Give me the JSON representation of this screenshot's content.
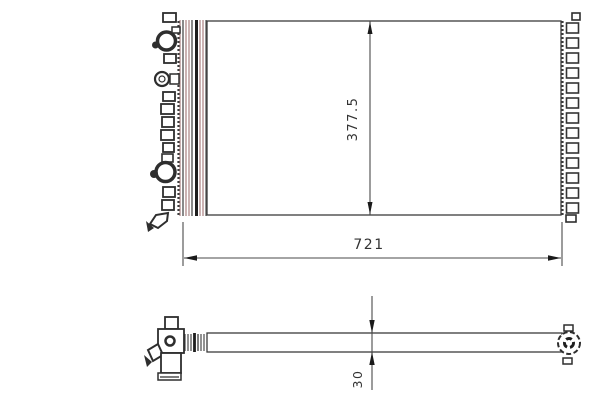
{
  "drawing": {
    "dimensions": {
      "height_label": "377.5",
      "width_label": "721",
      "thickness_label": "30"
    },
    "colors": {
      "background": "#ffffff",
      "line": "#3b3b3b",
      "fin_tint": "#b08a8a",
      "dimension_line": "#4a4a4a",
      "text": "#333333"
    }
  }
}
